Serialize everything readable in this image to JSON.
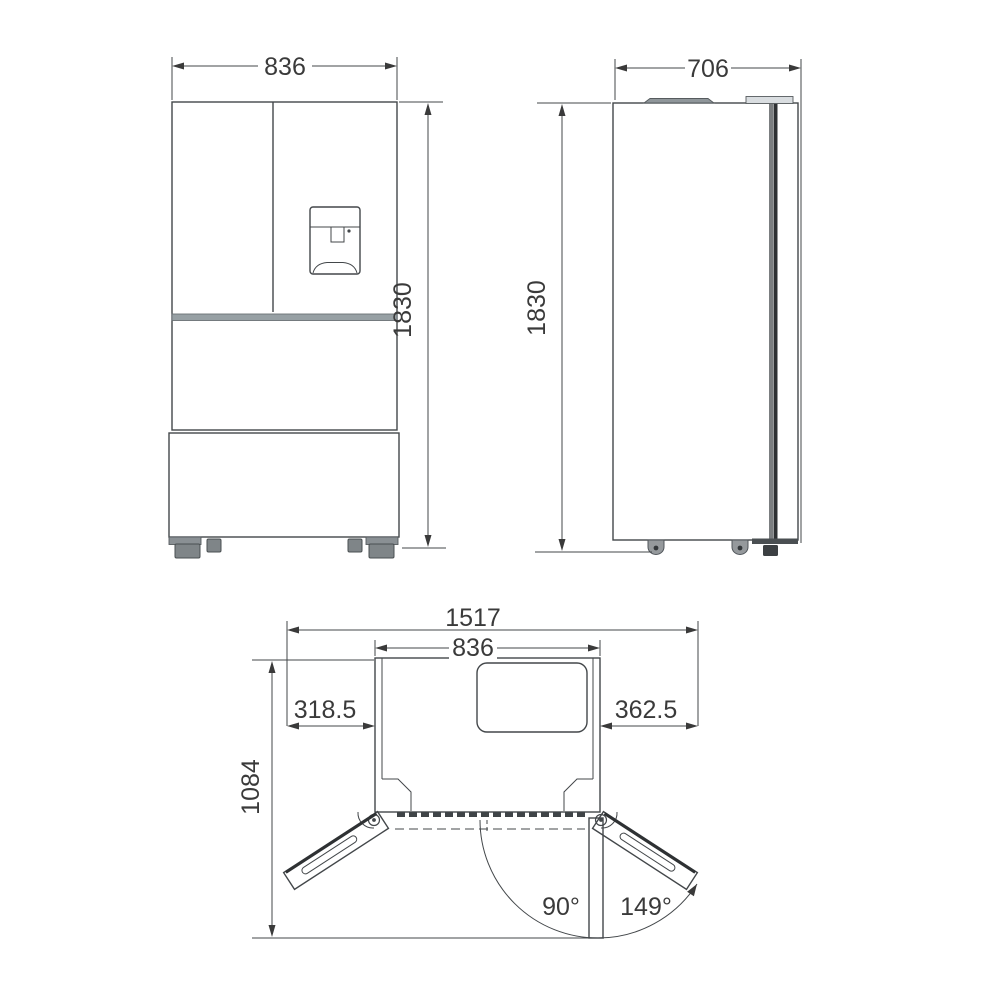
{
  "front_view": {
    "name": "refrigerator-front-elevation",
    "width": "836",
    "height": "1830"
  },
  "side_view": {
    "name": "refrigerator-side-elevation",
    "depth": "706",
    "height": "1830"
  },
  "top_view": {
    "name": "refrigerator-plan-doors-open",
    "total_width_open": "1517",
    "cabinet_width": "836",
    "left_door_projection": "318.5",
    "right_door_projection": "362.5",
    "depth_doors_open": "1084",
    "door_angle_90": "90°",
    "door_angle_149": "149°"
  },
  "colors": {
    "line": "#43474a",
    "text": "#3a3a3a",
    "gray_fill": "#8f979b"
  }
}
